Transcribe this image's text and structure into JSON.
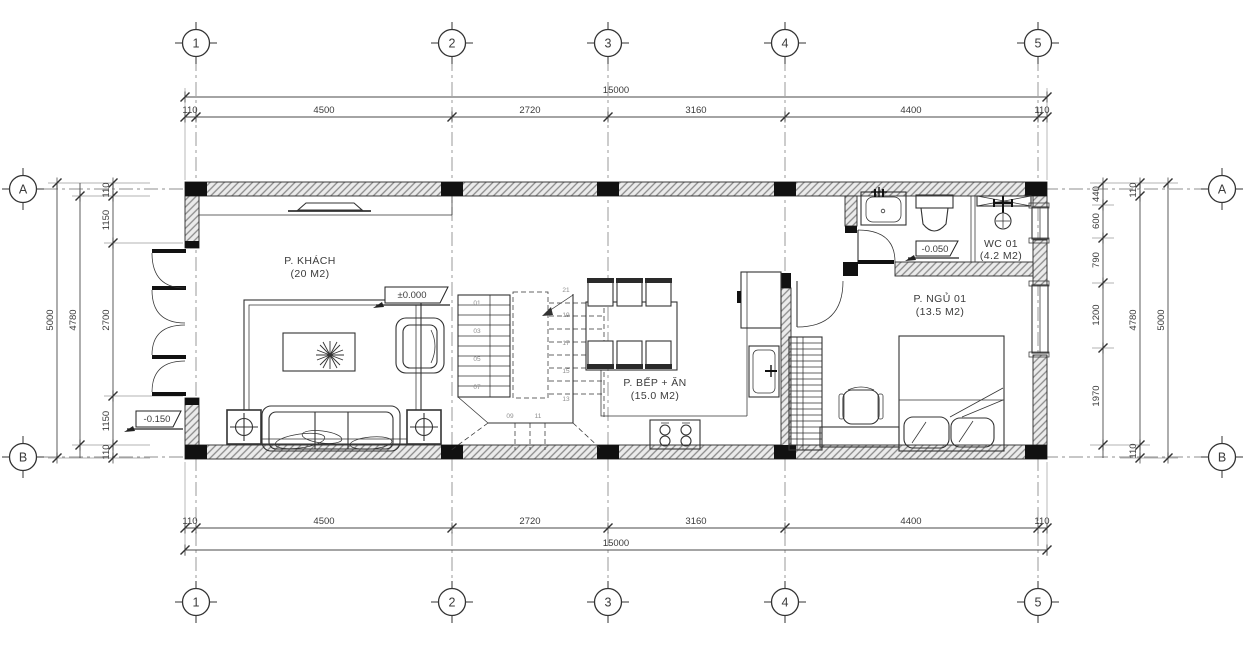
{
  "drawing": {
    "type": "floor-plan",
    "colors": {
      "ink": "#333333",
      "wall_fill": "#ebebeb",
      "column": "#111111",
      "background": "#ffffff",
      "text": "#3b3b3b"
    }
  },
  "grid": {
    "cols": [
      "1",
      "2",
      "3",
      "4",
      "5"
    ],
    "rows": [
      "A",
      "B"
    ]
  },
  "dims": {
    "top": {
      "overall": "15000",
      "segments": [
        "110",
        "4500",
        "2720",
        "3160",
        "4400",
        "110"
      ]
    },
    "bottom": {
      "overall": "15000",
      "segments": [
        "110",
        "4500",
        "2720",
        "3160",
        "4400",
        "110"
      ]
    },
    "left": {
      "overall": "5000",
      "inner": "4780",
      "segments": [
        "110",
        "1150",
        "2700",
        "1150",
        "110"
      ]
    },
    "right": {
      "overall": "5000",
      "inner": "4780",
      "edge_top": "110",
      "edge_bottom": "110",
      "segments": [
        "440",
        "600",
        "790",
        "1200",
        "1970"
      ]
    }
  },
  "rooms": {
    "living": {
      "name": "P. KHÁCH",
      "area": "(20 M2)"
    },
    "kitchen": {
      "name": "P. BẾP + ĂN",
      "area": "(15.0 M2)"
    },
    "bedroom": {
      "name": "P. NGỦ 01",
      "area": "(13.5 M2)"
    },
    "wc": {
      "name": "WC 01",
      "area": "(4.2 M2)"
    }
  },
  "levels": {
    "living": "±0.000",
    "entry": "-0.150",
    "wc": "-0.050"
  },
  "stairs": {
    "numbers": [
      "01",
      "03",
      "05",
      "07",
      "09",
      "11",
      "13",
      "15",
      "17",
      "19",
      "21"
    ]
  }
}
